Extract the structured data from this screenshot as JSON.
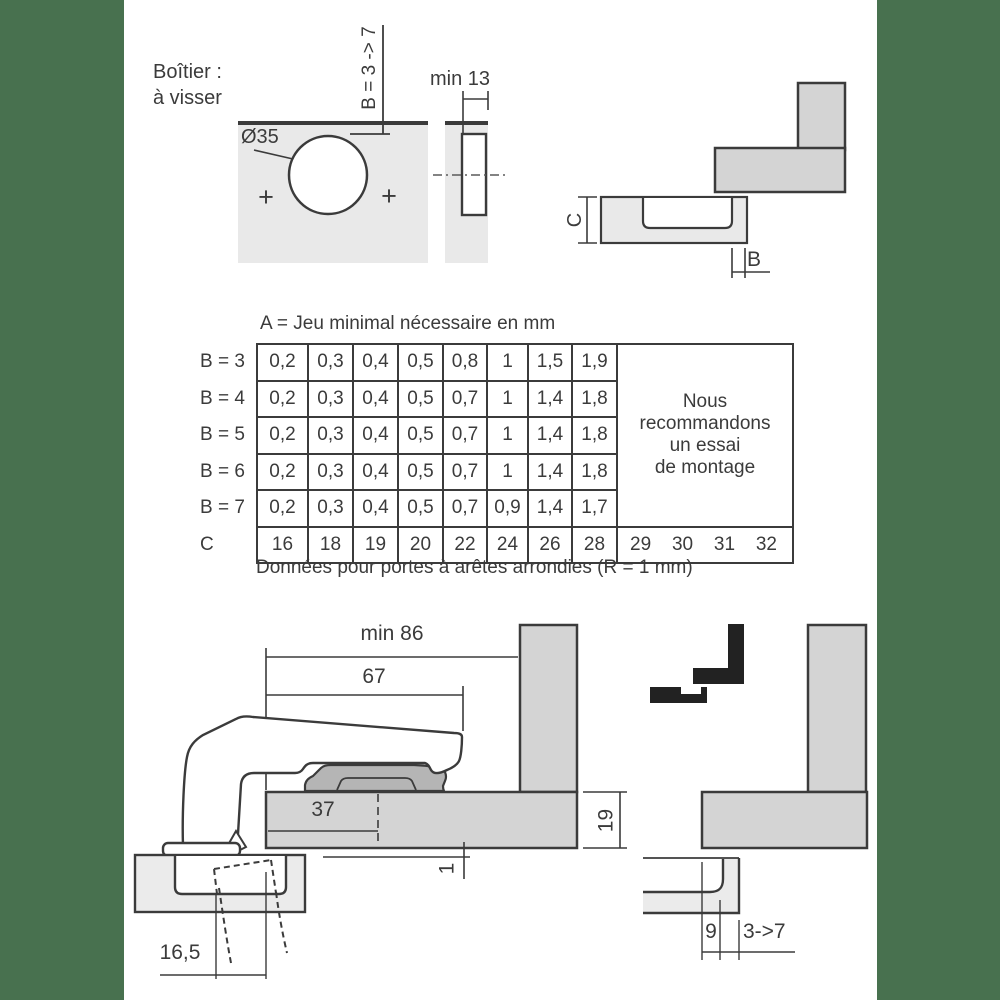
{
  "page": {
    "background": "#ffffff",
    "margin_band_color": "#48714f",
    "line_color": "#3b3b3b"
  },
  "header": {
    "line1": "Boîtier :",
    "line2": "à visser"
  },
  "drilling_diagram": {
    "diameter_label": "Ø35",
    "cup_distance_label": "B = 3 -> 7",
    "min_width_label": "min 13",
    "screw_mark": "+"
  },
  "corner_diagram": {
    "dim_c": "C",
    "dim_b": "B"
  },
  "table": {
    "title": "A = Jeu minimal nécessaire en mm",
    "rows": [
      {
        "label": "B = 3",
        "values": [
          "0,2",
          "0,3",
          "0,4",
          "0,5",
          "0,8",
          "1",
          "1,5",
          "1,9"
        ]
      },
      {
        "label": "B = 4",
        "values": [
          "0,2",
          "0,3",
          "0,4",
          "0,5",
          "0,7",
          "1",
          "1,4",
          "1,8"
        ]
      },
      {
        "label": "B = 5",
        "values": [
          "0,2",
          "0,3",
          "0,4",
          "0,5",
          "0,7",
          "1",
          "1,4",
          "1,8"
        ]
      },
      {
        "label": "B = 6",
        "values": [
          "0,2",
          "0,3",
          "0,4",
          "0,5",
          "0,7",
          "1",
          "1,4",
          "1,8"
        ]
      },
      {
        "label": "B = 7",
        "values": [
          "0,2",
          "0,3",
          "0,4",
          "0,5",
          "0,7",
          "0,9",
          "1,4",
          "1,7"
        ]
      }
    ],
    "c_row": {
      "label": "C",
      "values": [
        "16",
        "18",
        "19",
        "20",
        "22",
        "24",
        "26",
        "28"
      ],
      "extra_values": [
        "29",
        "30",
        "31",
        "32"
      ]
    },
    "note_lines": [
      "Nous",
      "recommandons",
      "un essai",
      "de montage"
    ],
    "caption": "Données pour portes à arêtes arrondies (R = 1 mm)"
  },
  "overlay_drawing": {
    "dim_min86": "min 86",
    "dim_67": "67",
    "dim_37": "37",
    "dim_19": "19",
    "dim_1": "1",
    "dim_16_5": "16,5"
  },
  "inset_drawing": {
    "dim_9": "9",
    "dim_range": "3->7"
  }
}
